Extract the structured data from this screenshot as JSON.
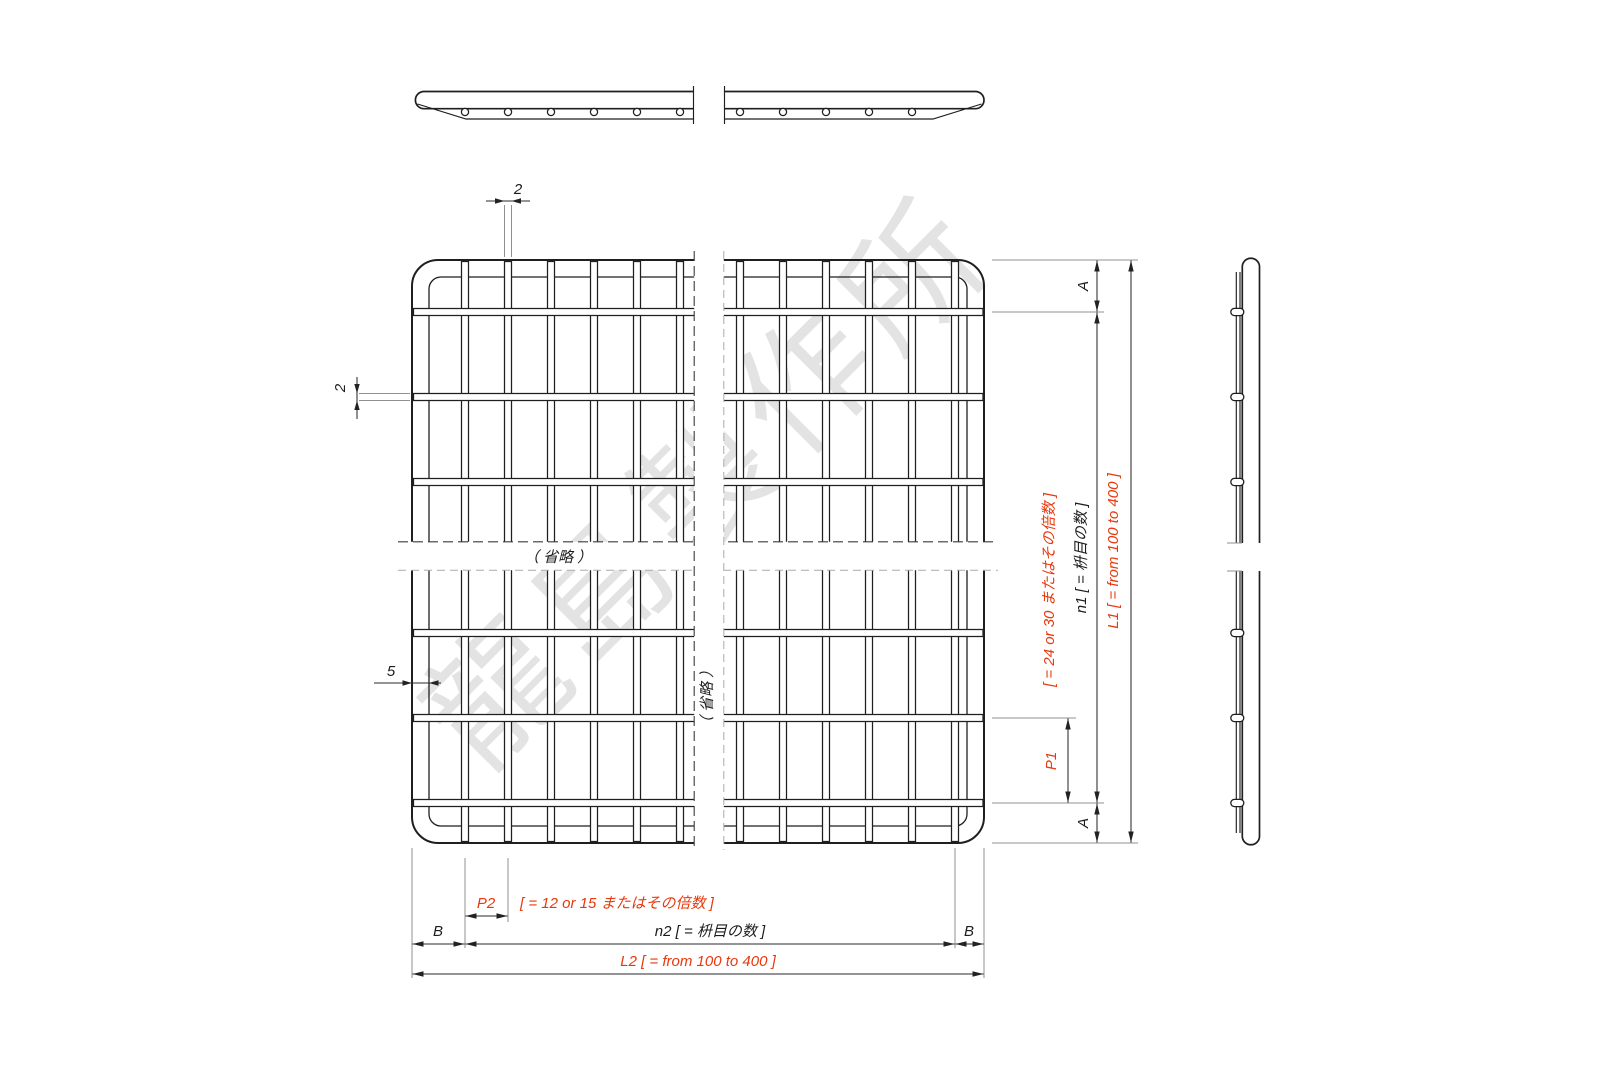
{
  "watermark": "龍島製作所",
  "annotations": {
    "wire_diameter_top": "2",
    "wire_diameter_left": "2",
    "frame_wire_diameter": "5",
    "omitted_horizontal": "（ 省略 ）",
    "omitted_vertical": "（ 省略 ）"
  },
  "dimensions_right": {
    "edge_top": "A",
    "edge_bottom": "A",
    "pitch": "P1",
    "pitch_note": "[ = 24 or 30 またはその倍数 ]",
    "mesh_count": "n1 [ = 枡目の数 ]",
    "length": "L1 [ = from 100 to 400 ]"
  },
  "dimensions_bottom": {
    "pitch": "P2",
    "pitch_note": "[ = 12 or 15 またはその倍数 ]",
    "border_left": "B",
    "border_right": "B",
    "mesh_count": "n2 [ = 枡目の数 ]",
    "length": "L2 [ = from 100 to 400 ]"
  },
  "colors": {
    "line": "#1f1f1f",
    "accent_red": "#e8380d",
    "extension_gray": "#909090",
    "watermark_gray": "#e3e3e3"
  }
}
